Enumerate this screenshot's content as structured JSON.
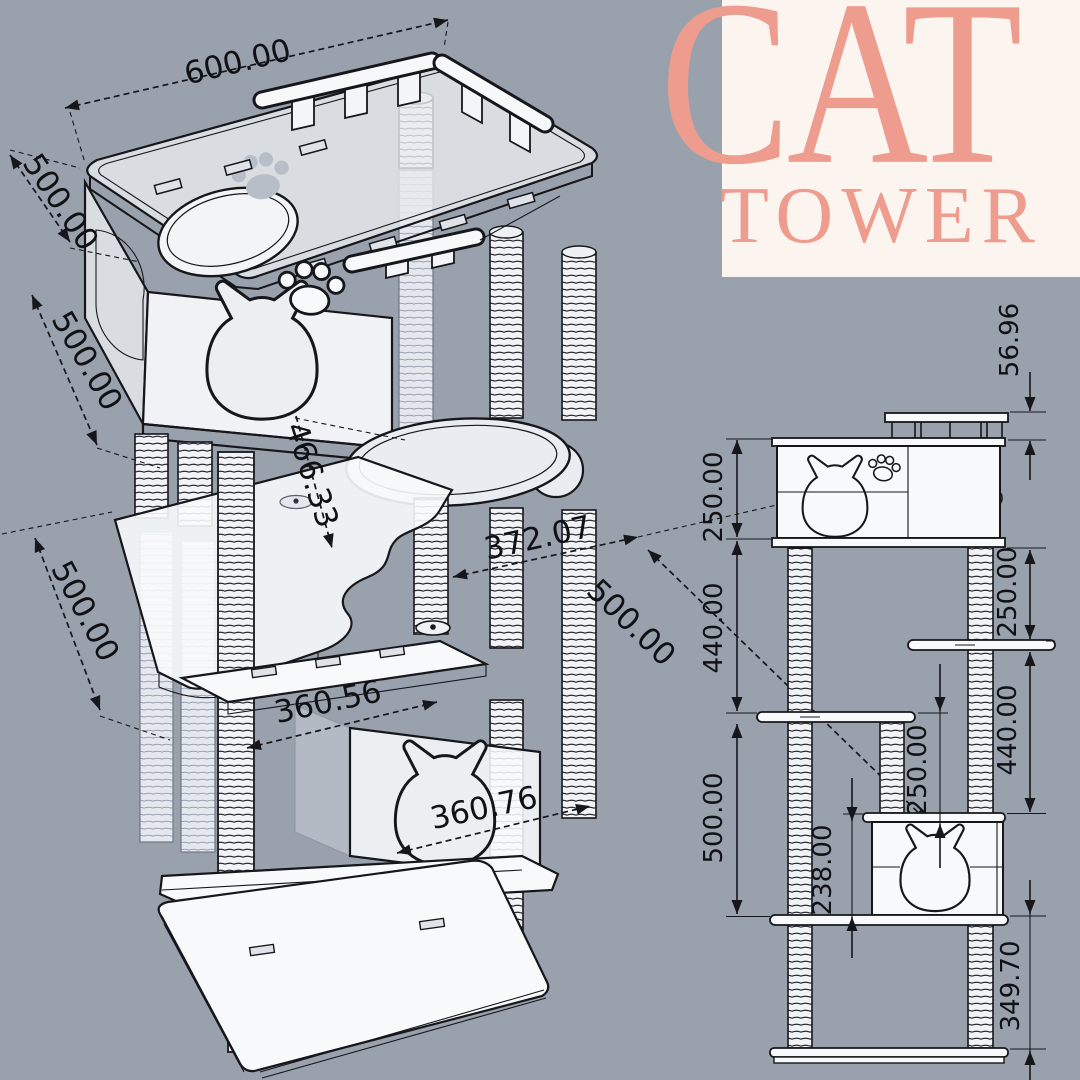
{
  "title": {
    "line1": "CAT",
    "line2": "TOWER"
  },
  "colors": {
    "background": "#99a1ad",
    "panel": "#fcf4ef",
    "accent_salmon": "#ee9c8e",
    "line_art": "#16171b",
    "surface_white": "#f7f9fb"
  },
  "iso_view": {
    "dims": {
      "top_width": "600.00",
      "top_depth": "500.00",
      "upper_height": "500.00",
      "mid_height": "500.00",
      "inner_diag": "466.33",
      "mid_diag": "372.07",
      "right_depth": "500.00",
      "mid_width": "360.56",
      "lower_width": "360.76"
    }
  },
  "elevation_view": {
    "dims": {
      "railing_height": "56.96",
      "left_box_height": "250.00",
      "left_gap": "440.00",
      "left_lower_gap": "500.00",
      "right_upper_gap": "250.00",
      "right_lower_gap": "440.00",
      "mid_platform_gap": "250.00",
      "lower_box_height": "238.00",
      "base_gap": "349.70"
    }
  }
}
